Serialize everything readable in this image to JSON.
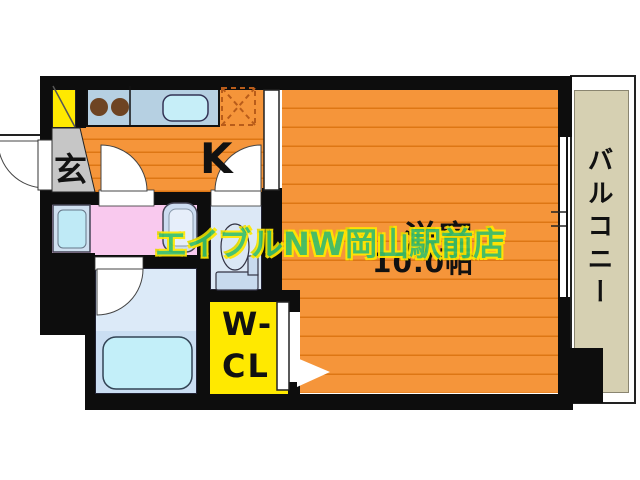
{
  "floorplan": {
    "genkan": {
      "label": "玄"
    },
    "kitchen": {
      "label": "K"
    },
    "main_room": {
      "name": "洋室",
      "size": "10.0帖"
    },
    "closet": {
      "line1": "W-",
      "line2": "CL"
    },
    "balcony": {
      "label": "バルコニー"
    },
    "watermark": "エイブルNW岡山駅前店",
    "colors": {
      "floor_orange": "#f5953a",
      "floor_line": "#dd7614",
      "wall_black": "#0d0d0d",
      "genkan_gray": "#c6c6c6",
      "accent_yellow": "#ffe900",
      "washroom_pink": "#f9c9ee",
      "bath_blue": "#dceaf8",
      "bath_blue_dark": "#cadef2",
      "tub_cyan": "#c3eff9",
      "fixture_blue": "#cfe0f0",
      "balcony_beige": "#d6d0b2",
      "watermark_green": "#3cc168",
      "watermark_outline": "#ffe800"
    }
  }
}
